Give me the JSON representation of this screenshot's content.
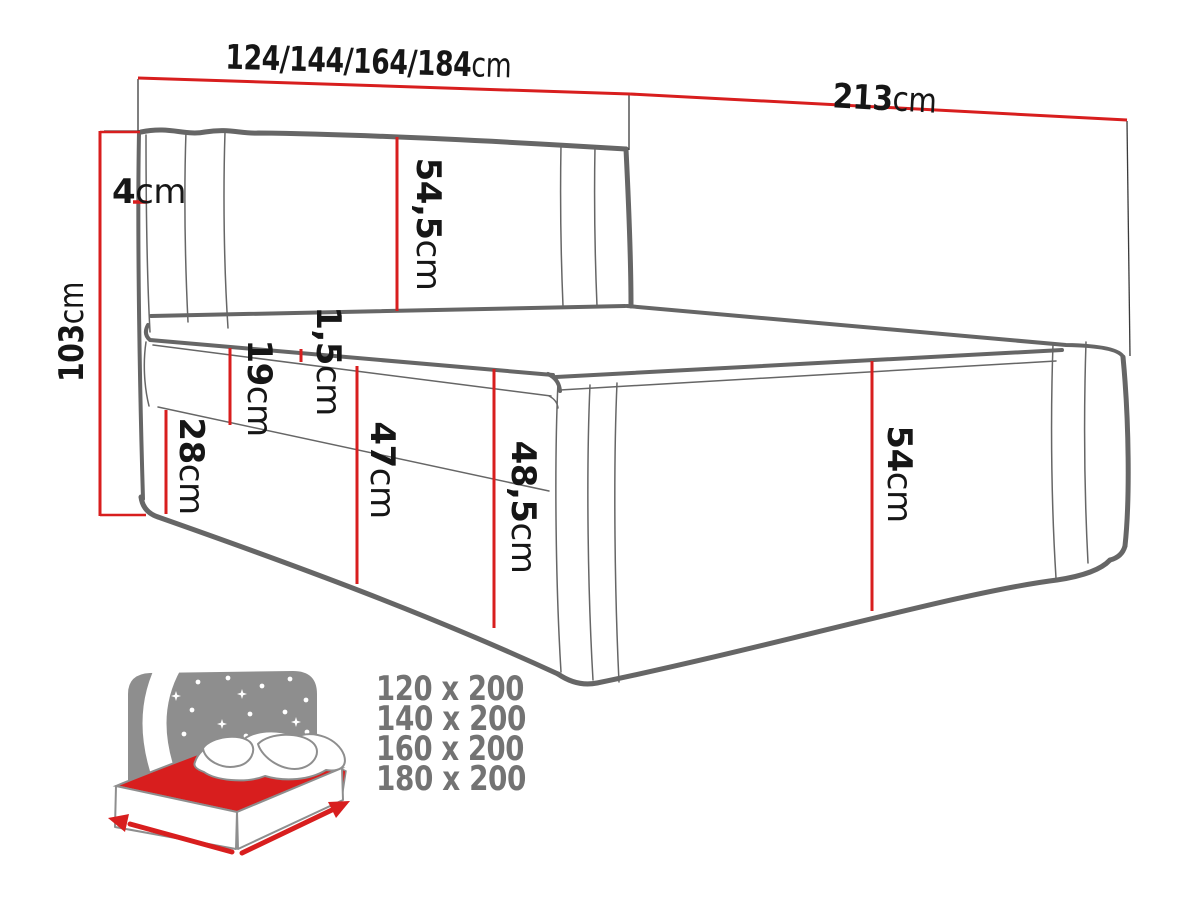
{
  "diagram": {
    "dimensions": {
      "width": {
        "value": "124/144/164/184",
        "unit": "cm"
      },
      "length": {
        "value": "213",
        "unit": "cm"
      },
      "height_total": {
        "value": "103",
        "unit": "cm"
      },
      "headboard_depth": {
        "value": "4",
        "unit": "cm"
      },
      "headboard_panel": {
        "value": "54,5",
        "unit": "cm"
      },
      "mattress_topper": {
        "value": "1,5",
        "unit": "cm"
      },
      "mattress_side": {
        "value": "19",
        "unit": "cm"
      },
      "base_side": {
        "value": "28",
        "unit": "cm"
      },
      "side_to_mattress": {
        "value": "47",
        "unit": "cm"
      },
      "side_to_top": {
        "value": "48,5",
        "unit": "cm"
      },
      "footboard_side": {
        "value": "54",
        "unit": "cm"
      }
    },
    "available_sizes": [
      "120 x 200",
      "140 x 200",
      "160 x 200",
      "180 x 200"
    ],
    "colors": {
      "dimension_red": "#d81e1e",
      "drawing_gray": "#666666",
      "icon_gray": "#8e8e8e",
      "list_gray": "#737373",
      "label_dark": "#161616"
    }
  }
}
